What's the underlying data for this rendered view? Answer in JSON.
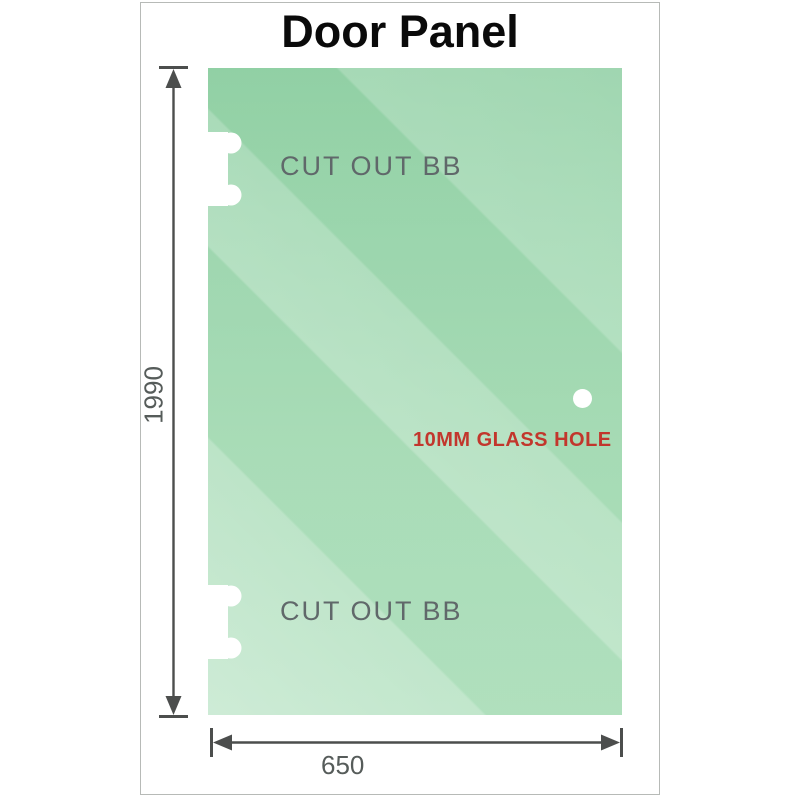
{
  "title": "Door Panel",
  "panel": {
    "cutout_top_label": "CUT OUT BB",
    "cutout_bottom_label": "CUT OUT BB",
    "hole_label": "10MM GLASS HOLE"
  },
  "dimensions": {
    "height": "1990",
    "width": "650"
  },
  "colors": {
    "glass_green_top": "#88cc9d",
    "glass_green_light": "#c9ead3",
    "hole_label_red": "#c2362c",
    "dimension_line_gray": "#4c4e4d",
    "cutout_label_gray": "#60686a",
    "frame_border_gray": "#b7bab7",
    "title_black": "#0a0a0a"
  }
}
